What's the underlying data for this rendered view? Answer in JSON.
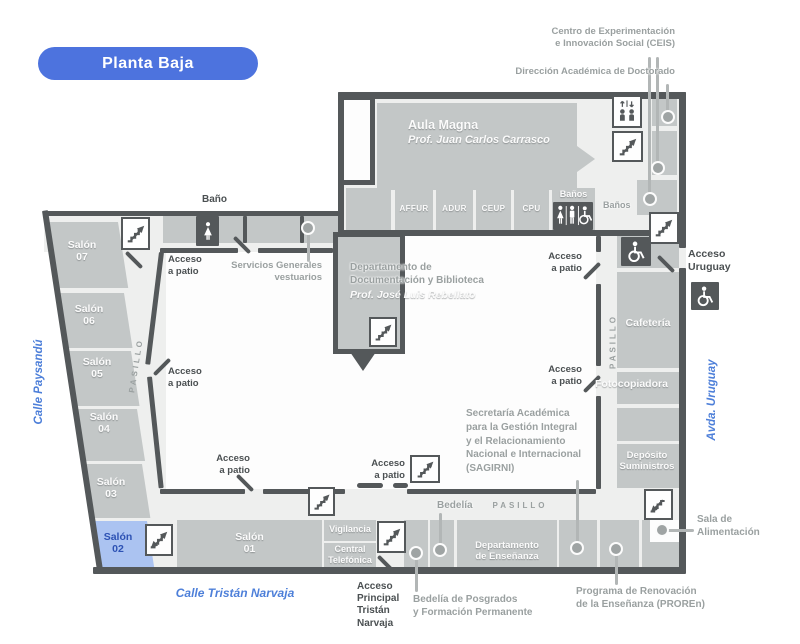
{
  "floor_selector": {
    "label": "Planta Baja"
  },
  "streets": {
    "west": "Calle Paysandú",
    "east": "Avda. Uruguay",
    "south": "Calle Tristán Narvaja"
  },
  "callouts": {
    "ceis": "Centro de Experimentación\ne Innovación Social (CEIS)",
    "doctorado": "Dirección Académica de Doctorado",
    "servicios_generales": "Servicios Generales\nvestuarios",
    "sagirni": "Secretaría Académica\npara la Gestión Integral\ny el Relacionamiento\nNacional e Internacional\n(SAGIRNI)",
    "bedelia_posgrados": "Bedelía de Posgrados\ny Formación Permanente",
    "proren": "Programa de Renovación\nde la Enseñanza (PROREn)",
    "sala_alimentacion": "Sala de\nAlimentación"
  },
  "accesses": {
    "patio": "Acceso\na patio",
    "uruguay": "Acceso\nUruguay",
    "principal": "Acceso\nPrincipal\nTristán\nNarvaja"
  },
  "rooms": {
    "aula_magna": {
      "name": "Aula Magna",
      "professor": "Prof. Juan Carlos Carrasco"
    },
    "documentacion": {
      "name": "Departamento de\nDocumentación y Biblioteca",
      "professor": "Prof. José Luis Rebellato"
    },
    "gremios": {
      "affur": "AFFUR",
      "adur": "ADUR",
      "ceup": "CEUP",
      "cpu": "CPU"
    },
    "banos": "Baños",
    "bano": "Baño",
    "cafeteria": "Cafetería",
    "fotocopiadora": "Fotocopiadora",
    "deposito": "Depósito\nSuministros",
    "vigilancia": "Vigilancia",
    "central_telefonica": "Central\nTelefónica",
    "departamento_ensenanza": "Departamento\nde Enseñanza",
    "bedelia": "Bedelía",
    "salones": {
      "s01": "Salón\n01",
      "s02": "Salón\n02",
      "s03": "Salón\n03",
      "s04": "Salón\n04",
      "s05": "Salón\n05",
      "s06": "Salón\n06",
      "s07": "Salón\n07"
    }
  },
  "corridors": {
    "pasillo": "PASILLO"
  },
  "icons": {
    "stairs_up": "stairs-up-icon",
    "stairs_down": "stairs-down-icon",
    "stairs_both": "stairs-both-icon",
    "elevator": "elevator-icon",
    "restroom_women": "restroom-women-icon",
    "restroom_accessible": "restroom-mixed-accessible-icon",
    "wheelchair": "wheelchair-accessible-icon"
  },
  "colors": {
    "accent_blue": "#4d73de",
    "street_blue": "#4d7fd9",
    "highlight_room": "#abc3f1",
    "highlight_text": "#2d52b4",
    "wall": "#54585a",
    "room_fill": "#c3c7c7",
    "floor_fill": "#eeefee",
    "label_gray": "#9aa0a0",
    "label_dark": "#4b5052"
  }
}
